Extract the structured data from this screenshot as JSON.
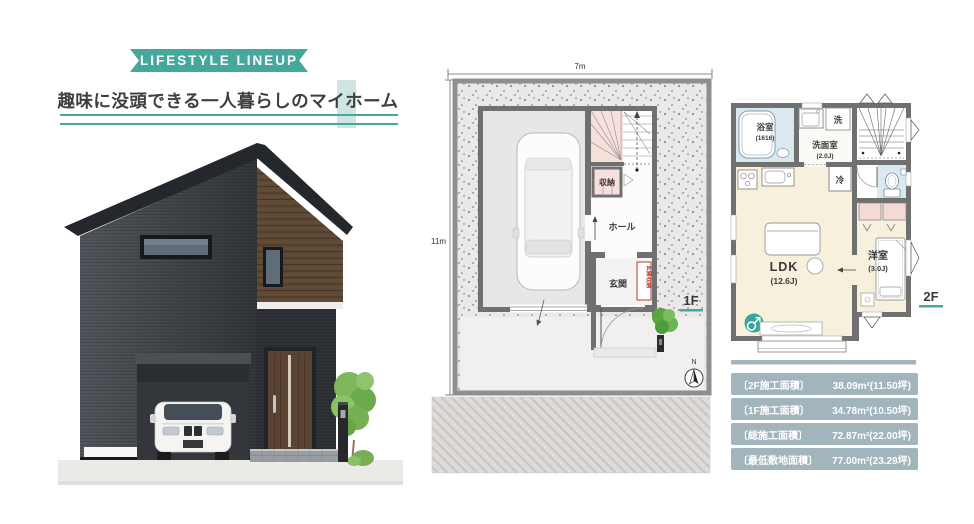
{
  "colors": {
    "accent_teal": "#44a89d",
    "accent_teal_light": "#cfe5e2",
    "table_row_bg": "#a2b5bc",
    "plan_pink": "#f6dcd8",
    "plan_cream": "#f7f0dd",
    "plan_light_blue": "#dae8f0",
    "wall_gray": "#707070"
  },
  "header": {
    "ribbon_label": "LIFESTYLE LINEUP",
    "subtitle": "趣味に没頭できる一人暮らしのマイホーム"
  },
  "plan_1f": {
    "floor_label": "1F",
    "width_dim": "7m",
    "height_dim": "11m",
    "compass": "N",
    "rooms": {
      "hall": "ホール",
      "entrance": "玄関",
      "entrance_storage": "玄関収納",
      "storage": "収納"
    }
  },
  "plan_2f": {
    "floor_label": "2F",
    "rooms": {
      "bath": "浴室",
      "bath_size": "(1616)",
      "washroom": "洗面室",
      "washroom_size": "(2.0J)",
      "laundry": "洗",
      "fridge": "冷",
      "ldk": "LDK",
      "ldk_size": "(12.6J)",
      "western_room": "洋室",
      "western_room_size": "(3.0J)"
    }
  },
  "area_table": {
    "rows": [
      {
        "label": "〔2F施工面積〕",
        "value": "38.09m²(11.50坪)"
      },
      {
        "label": "〔1F施工面積〕",
        "value": "34.78m²(10.50坪)"
      },
      {
        "label": "〔総施工面積〕",
        "value": "72.87m²(22.00坪)"
      },
      {
        "label": "〔最低敷地面積〕",
        "value": "77.00m²(23.29坪)"
      }
    ]
  }
}
